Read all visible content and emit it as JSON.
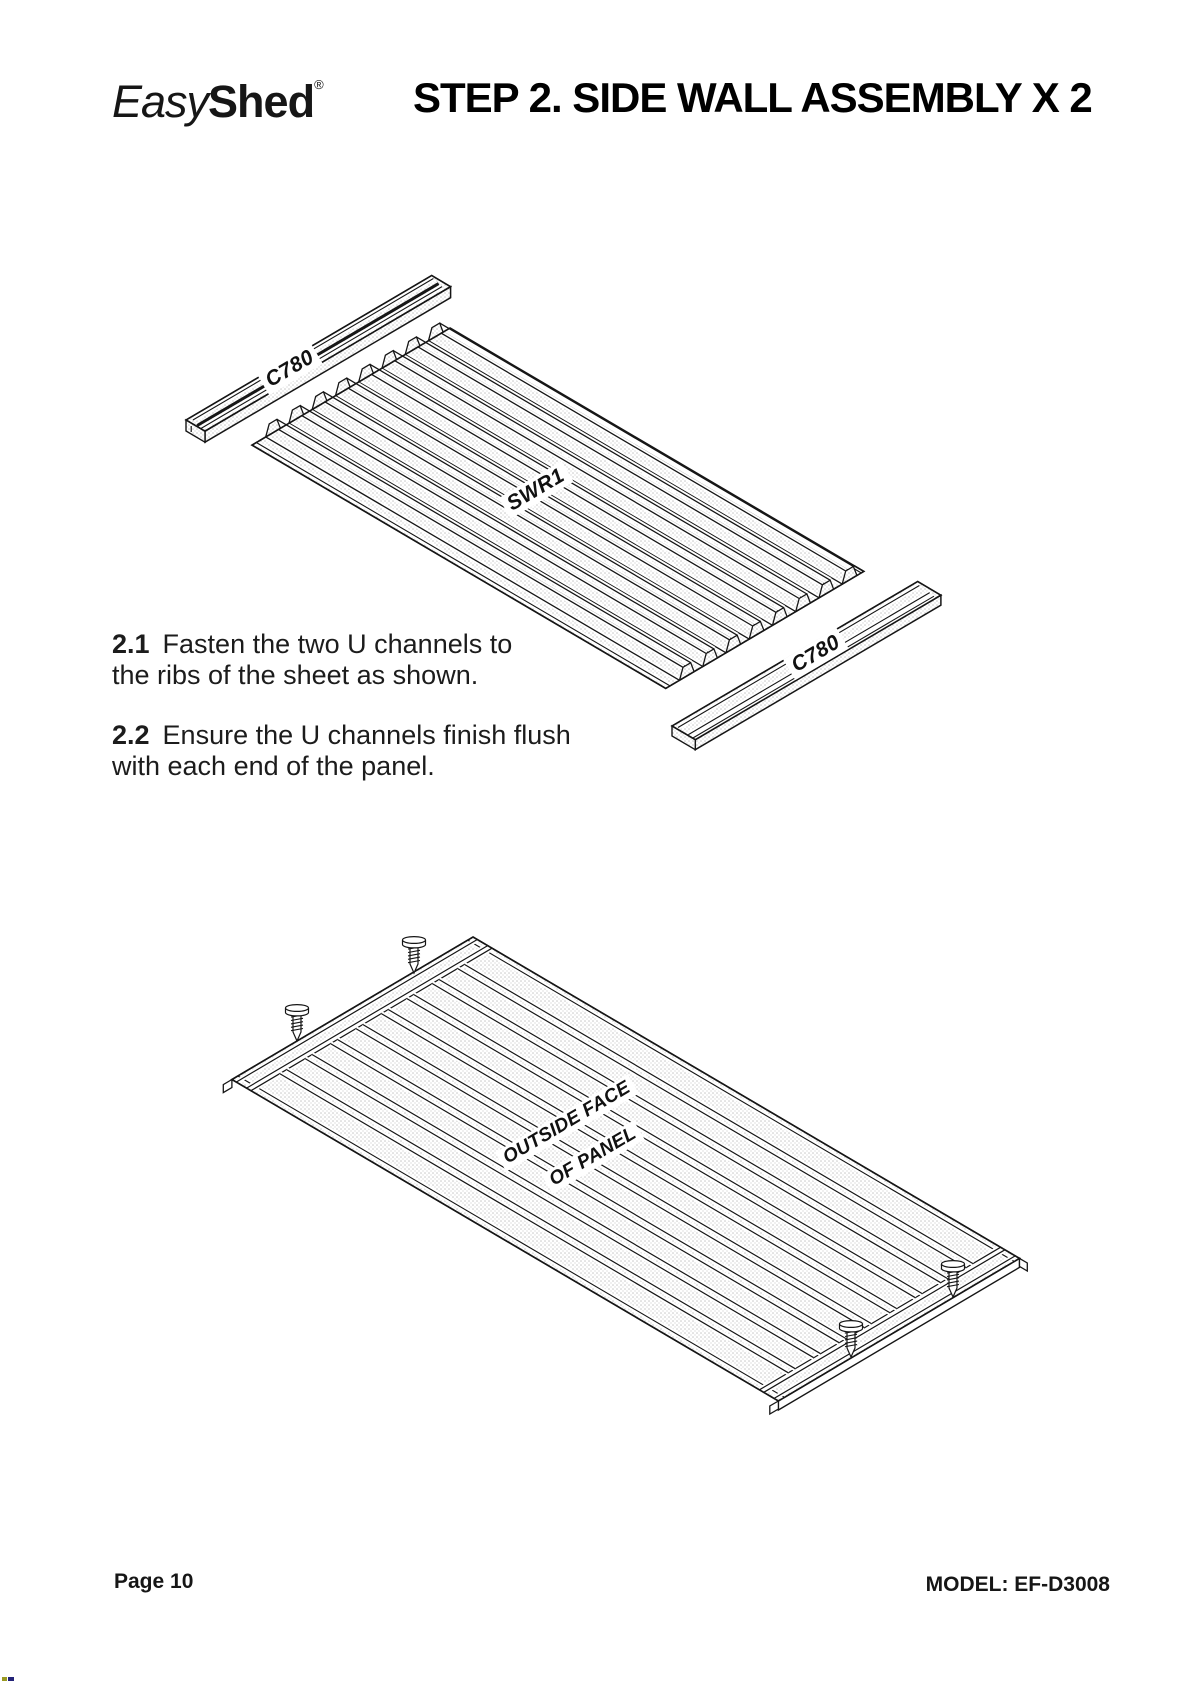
{
  "header": {
    "logo_easy": "Easy",
    "logo_shed": "Shed",
    "logo_reg": "®",
    "title": "STEP 2. SIDE WALL ASSEMBLY X 2"
  },
  "instructions": [
    {
      "number": "2.1",
      "line1": "Fasten the two U channels to",
      "line2": "the ribs of the sheet as shown."
    },
    {
      "number": "2.2",
      "line1": "Ensure the U channels finish flush",
      "line2": "with each end of the panel."
    }
  ],
  "diagram1": {
    "channel_top_label": "C780",
    "panel_label": "SWR1",
    "channel_bottom_label": "C780"
  },
  "diagram2": {
    "face_label_line1": "OUTSIDE FACE",
    "face_label_line2": "OF PANEL"
  },
  "footer": {
    "page": "Page 10",
    "model": "MODEL: EF-D3008"
  }
}
